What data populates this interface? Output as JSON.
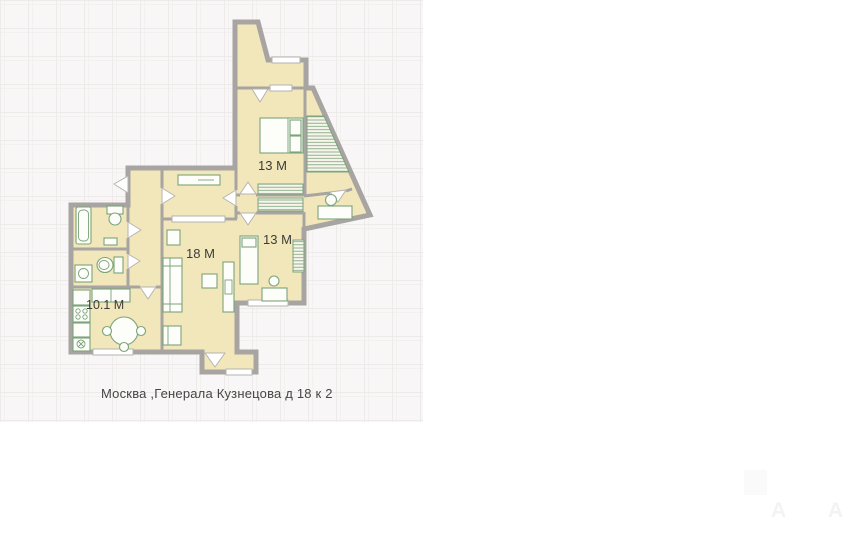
{
  "plan": {
    "rooms": [
      {
        "id": "bedroom-top",
        "label": "13 М"
      },
      {
        "id": "bedroom-right",
        "label": "13 М"
      },
      {
        "id": "living-room",
        "label": "18 М"
      },
      {
        "id": "kitchen",
        "label": "10.1 М"
      }
    ],
    "colors": {
      "room_fill": "#f2e7ba",
      "wall": "#a7a4a1",
      "furniture": "#7aa47a",
      "grid_bg": "#f8f6f6",
      "grid_line": "#edeae9",
      "grid_line2": "#f3f1f0",
      "caption": "#464646",
      "watermark": "#f4f3f2"
    }
  },
  "caption": {
    "text": "Москва ,Генерала Кузнецова д 18 к 2"
  },
  "watermark": {
    "glyph": "A"
  }
}
